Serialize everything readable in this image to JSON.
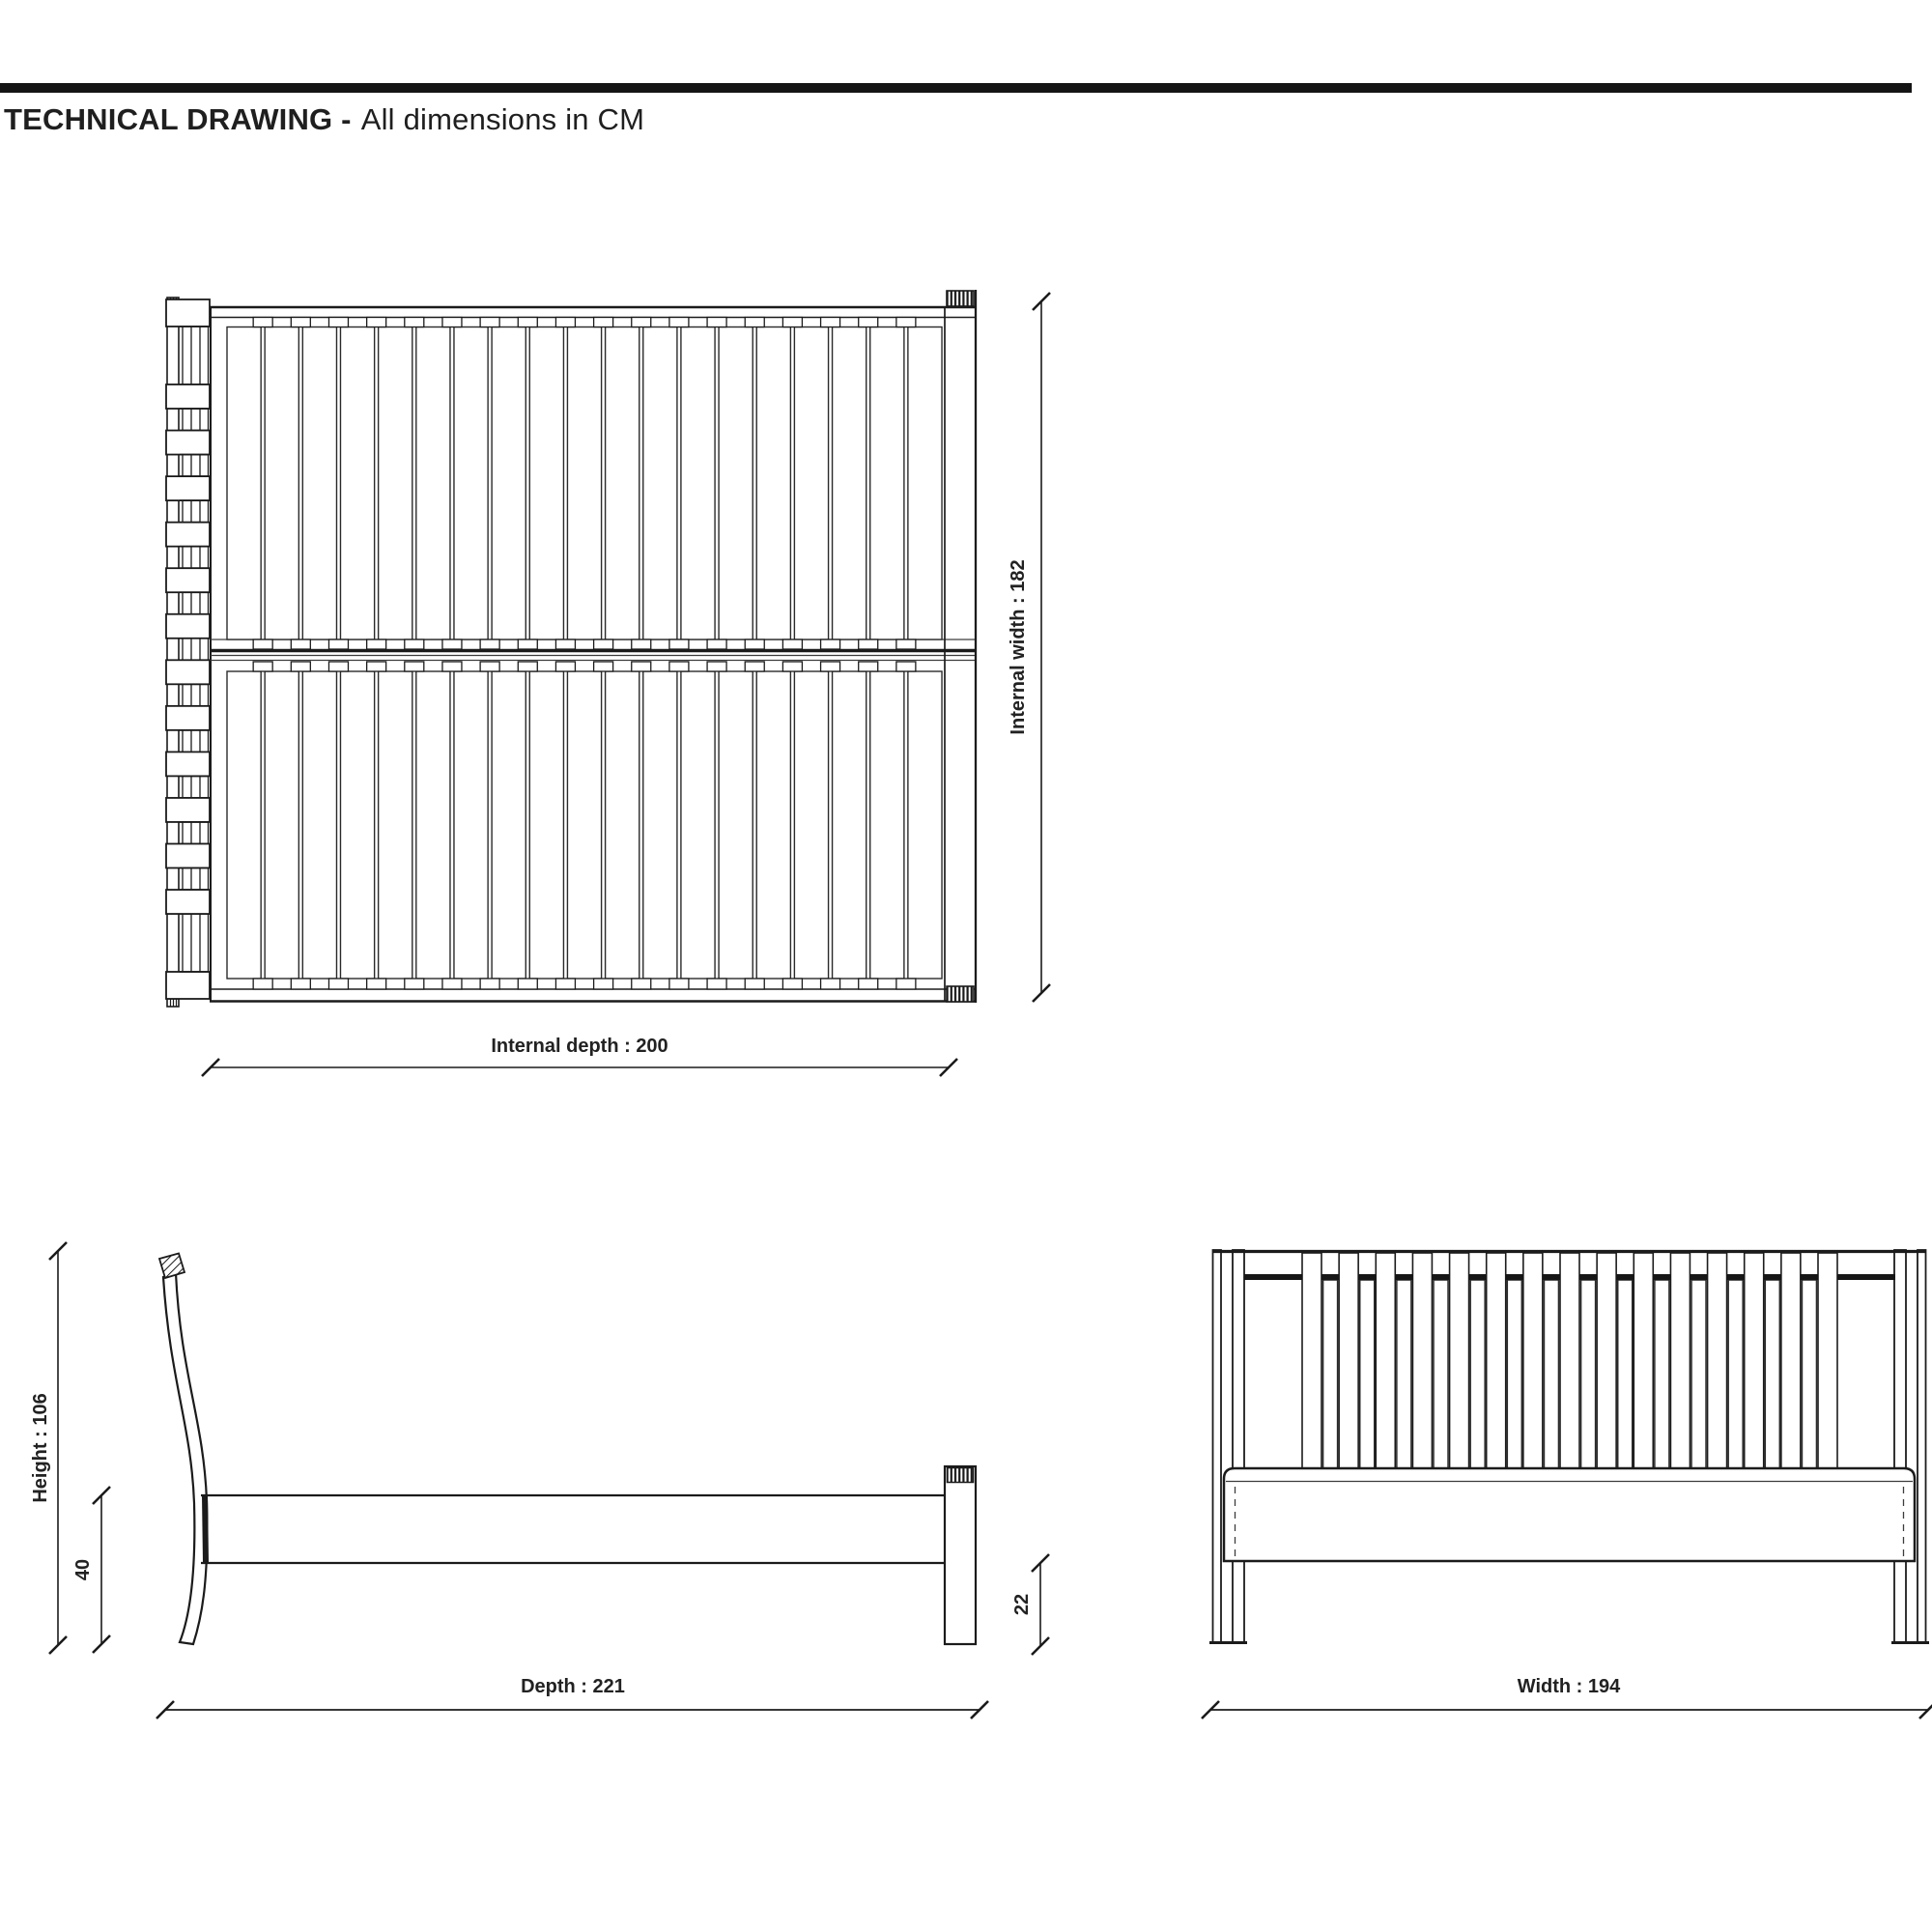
{
  "header": {
    "title_bold": "TECHNICAL DRAWING -",
    "title_rest": "All dimensions in CM"
  },
  "colors": {
    "background": "#ffffff",
    "bar": "#141414",
    "line": "#1b1b1b",
    "thin_line": "#3c3c3c",
    "text": "#222222"
  },
  "drawing": {
    "top_view": {
      "name": "top view (bed base plan)",
      "slat_count": 19,
      "headboard_block_count": 12,
      "internal_width": {
        "label": "Internal width : 182",
        "value": 182
      },
      "internal_depth": {
        "label": "Internal depth : 200",
        "value": 200
      }
    },
    "side_view": {
      "name": "side view",
      "height": {
        "label": "Height : 106",
        "value": 106
      },
      "rail_top_height": {
        "label": "40",
        "value": 40
      },
      "under_rail_height": {
        "label": "22",
        "value": 22
      },
      "depth": {
        "label": "Depth : 221",
        "value": 221
      }
    },
    "front_view": {
      "name": "front view (headboard)",
      "front_slat_count": 15,
      "back_slat_count": 14,
      "width": {
        "label": "Width : 194",
        "value": 194
      }
    }
  }
}
